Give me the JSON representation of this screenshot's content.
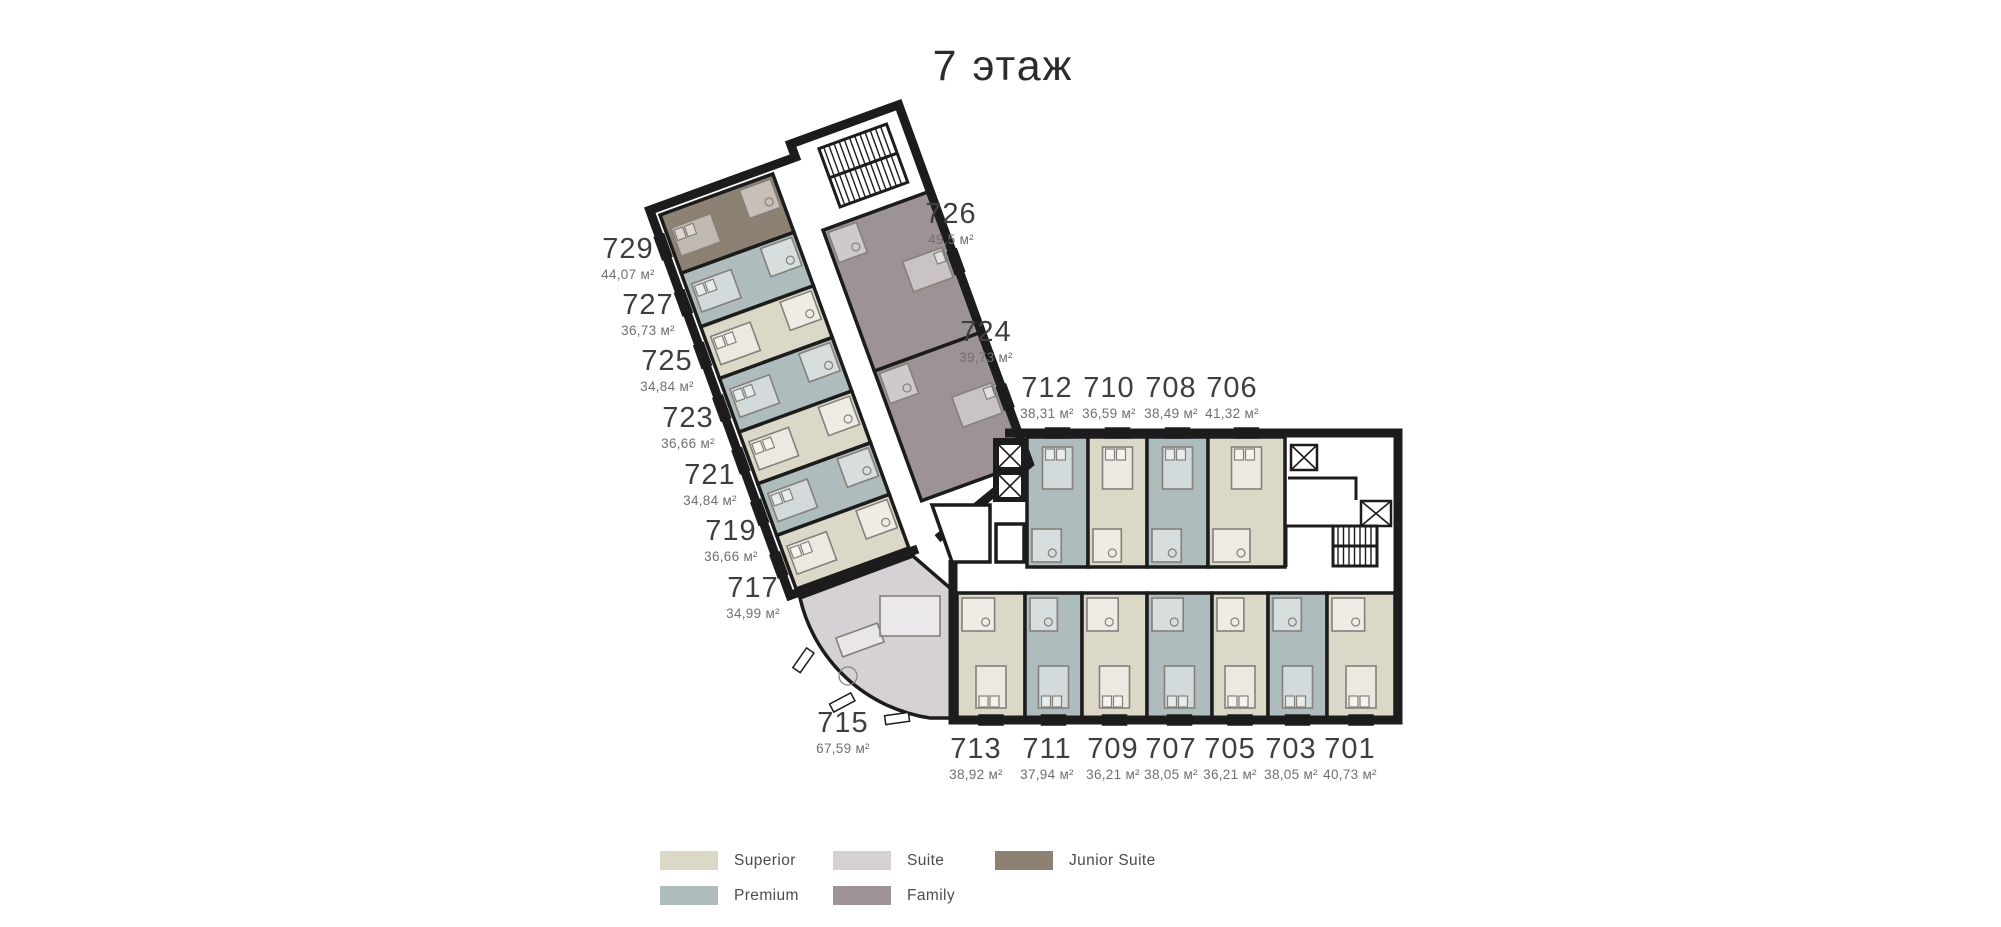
{
  "title": "7 этаж",
  "legend": {
    "items": [
      {
        "id": "superior",
        "label": "Superior",
        "color": "#dcd8c8"
      },
      {
        "id": "premium",
        "label": "Premium",
        "color": "#aebcbd"
      },
      {
        "id": "suite",
        "label": "Suite",
        "color": "#d5d1d4"
      },
      {
        "id": "family",
        "label": "Family",
        "color": "#9d9396"
      },
      {
        "id": "junior_suite",
        "label": "Junior Suite",
        "color": "#8c8173"
      }
    ]
  },
  "rooms": [
    {
      "number": "729",
      "area": "44,07 м²",
      "type": "junior_suite"
    },
    {
      "number": "727",
      "area": "36,73 м²",
      "type": "premium"
    },
    {
      "number": "725",
      "area": "34,84 м²",
      "type": "superior"
    },
    {
      "number": "723",
      "area": "36,66 м²",
      "type": "premium"
    },
    {
      "number": "721",
      "area": "34,84 м²",
      "type": "superior"
    },
    {
      "number": "719",
      "area": "36,66 м²",
      "type": "premium"
    },
    {
      "number": "717",
      "area": "34,99 м²",
      "type": "superior"
    },
    {
      "number": "715",
      "area": "67,59 м²",
      "type": "suite"
    },
    {
      "number": "726",
      "area": "49,5 м²",
      "type": "family"
    },
    {
      "number": "724",
      "area": "39,73 м²",
      "type": "family"
    },
    {
      "number": "712",
      "area": "38,31 м²",
      "type": "premium"
    },
    {
      "number": "710",
      "area": "36,59 м²",
      "type": "superior"
    },
    {
      "number": "708",
      "area": "38,49 м²",
      "type": "premium"
    },
    {
      "number": "706",
      "area": "41,32 м²",
      "type": "superior"
    },
    {
      "number": "713",
      "area": "38,92 м²",
      "type": "superior"
    },
    {
      "number": "711",
      "area": "37,94 м²",
      "type": "premium"
    },
    {
      "number": "709",
      "area": "36,21 м²",
      "type": "superior"
    },
    {
      "number": "707",
      "area": "38,05 м²",
      "type": "premium"
    },
    {
      "number": "705",
      "area": "36,21 м²",
      "type": "superior"
    },
    {
      "number": "703",
      "area": "38,05 м²",
      "type": "premium"
    },
    {
      "number": "701",
      "area": "40,73 м²",
      "type": "superior"
    }
  ]
}
